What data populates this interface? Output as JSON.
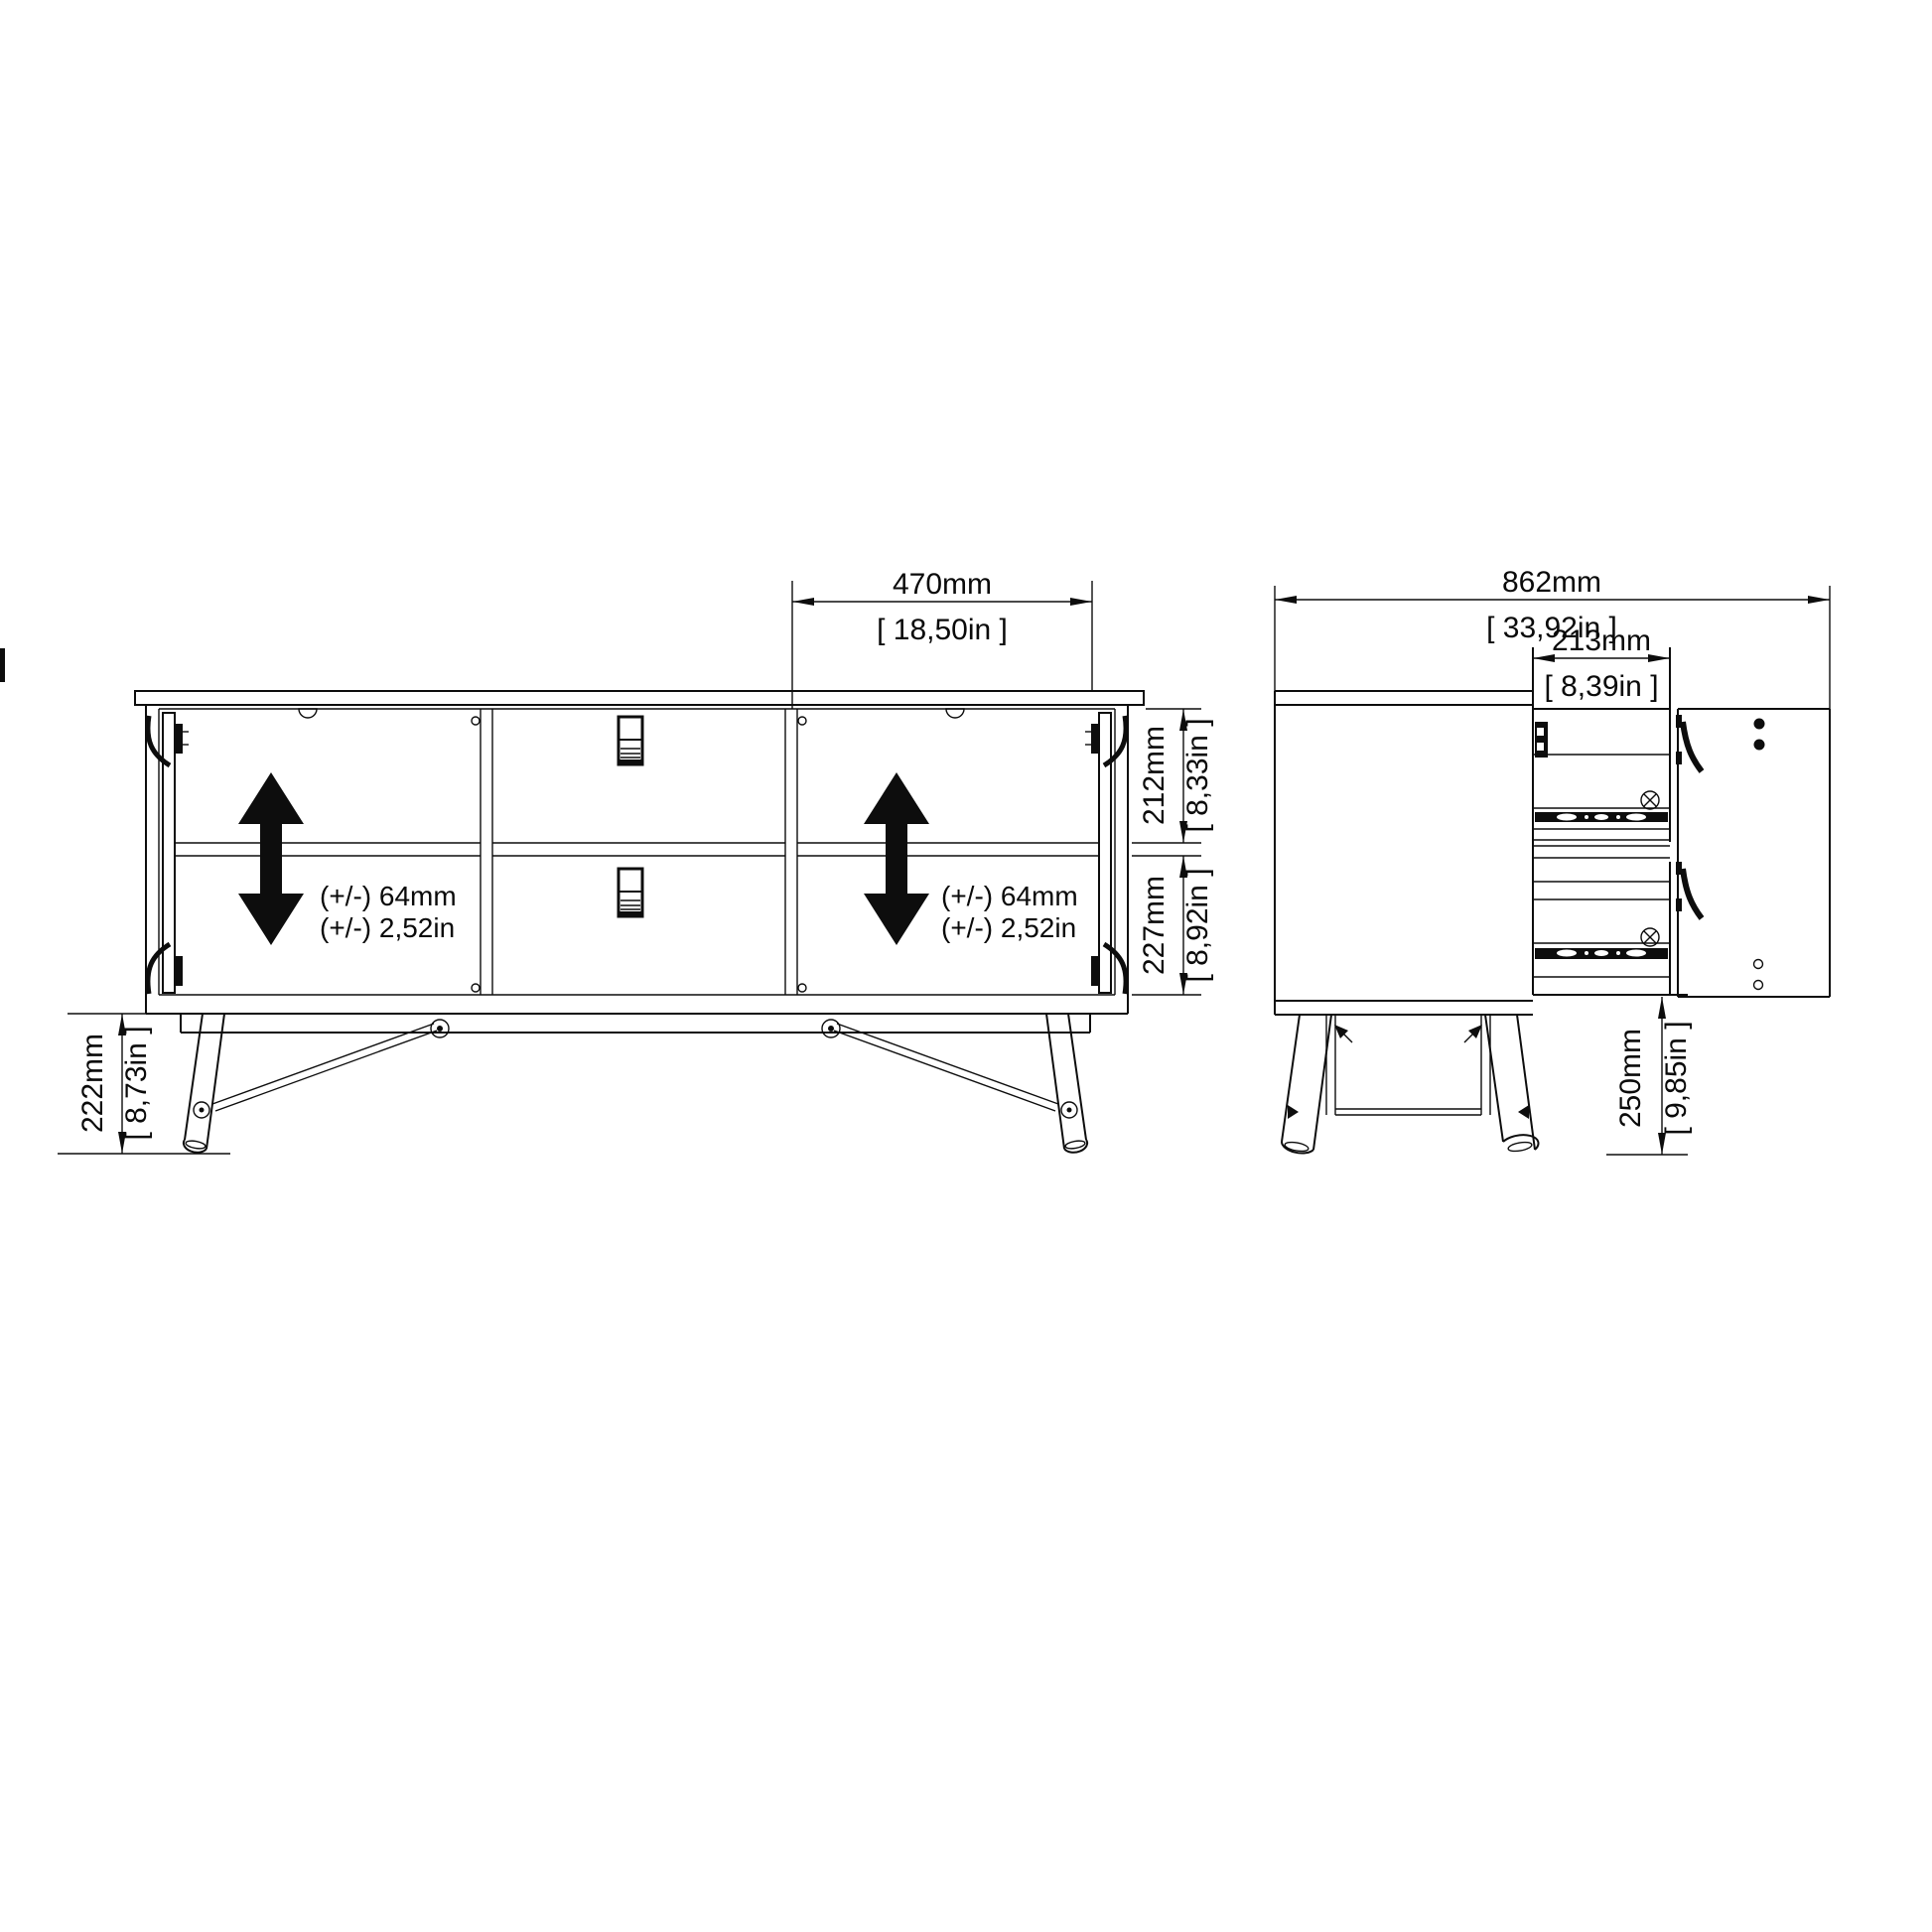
{
  "drawing": {
    "front_view": {
      "door_width": {
        "mm": "470mm",
        "in": "[ 18,50in ]"
      },
      "upper_compartment_height": {
        "mm": "212mm",
        "in": "[ 8,33in ]"
      },
      "lower_compartment_height": {
        "mm": "227mm",
        "in": "[ 8,92in ]"
      },
      "leg_height": {
        "mm": "222mm",
        "in": "[ 8,73in ]"
      },
      "shelf_adjust_left": {
        "line1": "(+/-) 64mm",
        "line2": "(+/-) 2,52in"
      },
      "shelf_adjust_right": {
        "line1": "(+/-) 64mm",
        "line2": "(+/-) 2,52in"
      }
    },
    "side_view": {
      "total_depth": {
        "mm": "862mm",
        "in": "[ 33,92in ]"
      },
      "drawer_depth": {
        "mm": "213mm",
        "in": "[ 8,39in ]"
      },
      "floor_clearance": {
        "mm": "250mm",
        "in": "[ 9,85in ]"
      }
    }
  }
}
